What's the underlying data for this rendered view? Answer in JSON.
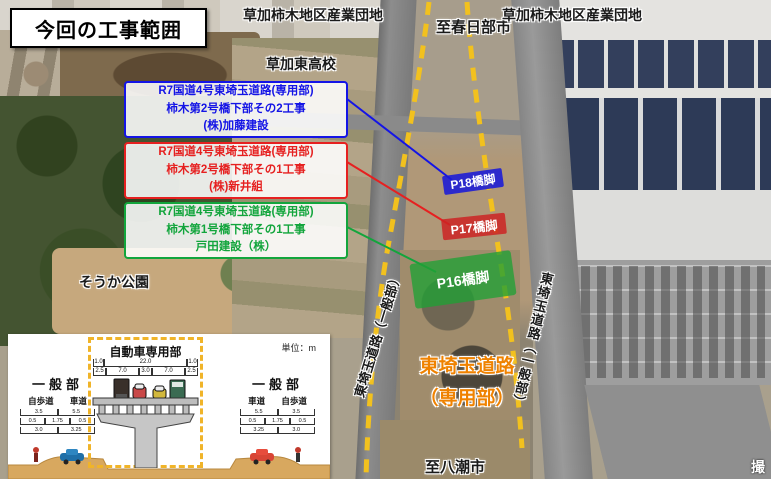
{
  "title": "今回の工事範囲",
  "photo_labels": {
    "industrial_left": "草加柿木地区産業団地",
    "industrial_right": "草加柿木地区産業団地",
    "to_kasukabe": "至春日部市",
    "highschool": "草加東高校",
    "park": "そうか公園",
    "to_yashio": "至八潮市",
    "road_general_left": "東埼玉道路（一般部）",
    "road_general_right": "東埼玉道路（一般部）",
    "road_exclusive_line1": "東埼玉道路",
    "road_exclusive_line2": "（専用部）",
    "photo_credit": "撮"
  },
  "callouts": [
    {
      "color": "#1414e6",
      "lines": [
        "R7国道4号東埼玉道路(専用部)",
        "柿木第2号橋下部その2工事",
        "(株)加藤建設"
      ],
      "pier_label": "P18橋脚"
    },
    {
      "color": "#e62020",
      "lines": [
        "R7国道4号東埼玉道路(専用部)",
        "柿木第2号橋下部その1工事",
        "(株)新井組"
      ],
      "pier_label": "P17橋脚"
    },
    {
      "color": "#12a53c",
      "lines": [
        "R7国道4号東埼玉道路(専用部)",
        "柿木第1号橋下部その1工事",
        "戸田建設（株）"
      ],
      "pier_label": "P16橋脚"
    }
  ],
  "cross_section": {
    "unit_label": "単位：m",
    "center_title": "自動車専用部",
    "dims_top": [
      "1.0",
      "22.0",
      "1.0"
    ],
    "dims_mid": [
      "2.5",
      "7.0",
      "3.0",
      "7.0",
      "2.5"
    ],
    "left": {
      "title": "一般部",
      "sub_a": "自歩道",
      "sub_b": "車道",
      "dims_top": [
        "3.5",
        "5.5"
      ],
      "dims_mid": [
        "0.5",
        "1.75",
        "0.5"
      ],
      "dims_bottom": [
        "3.0",
        "3.25"
      ]
    },
    "right": {
      "title": "一般部",
      "sub_a": "車道",
      "sub_b": "自歩道",
      "dims_top": [
        "5.5",
        "3.5"
      ],
      "dims_mid": [
        "0.5",
        "1.75",
        "0.5"
      ],
      "dims_bottom": [
        "3.25",
        "3.0"
      ]
    }
  },
  "colors": {
    "callout_blue": "#1414e6",
    "callout_red": "#e62020",
    "callout_green": "#12a53c",
    "dashed_route": "#f2c11e",
    "exclusive_road_text": "#ef8200"
  }
}
